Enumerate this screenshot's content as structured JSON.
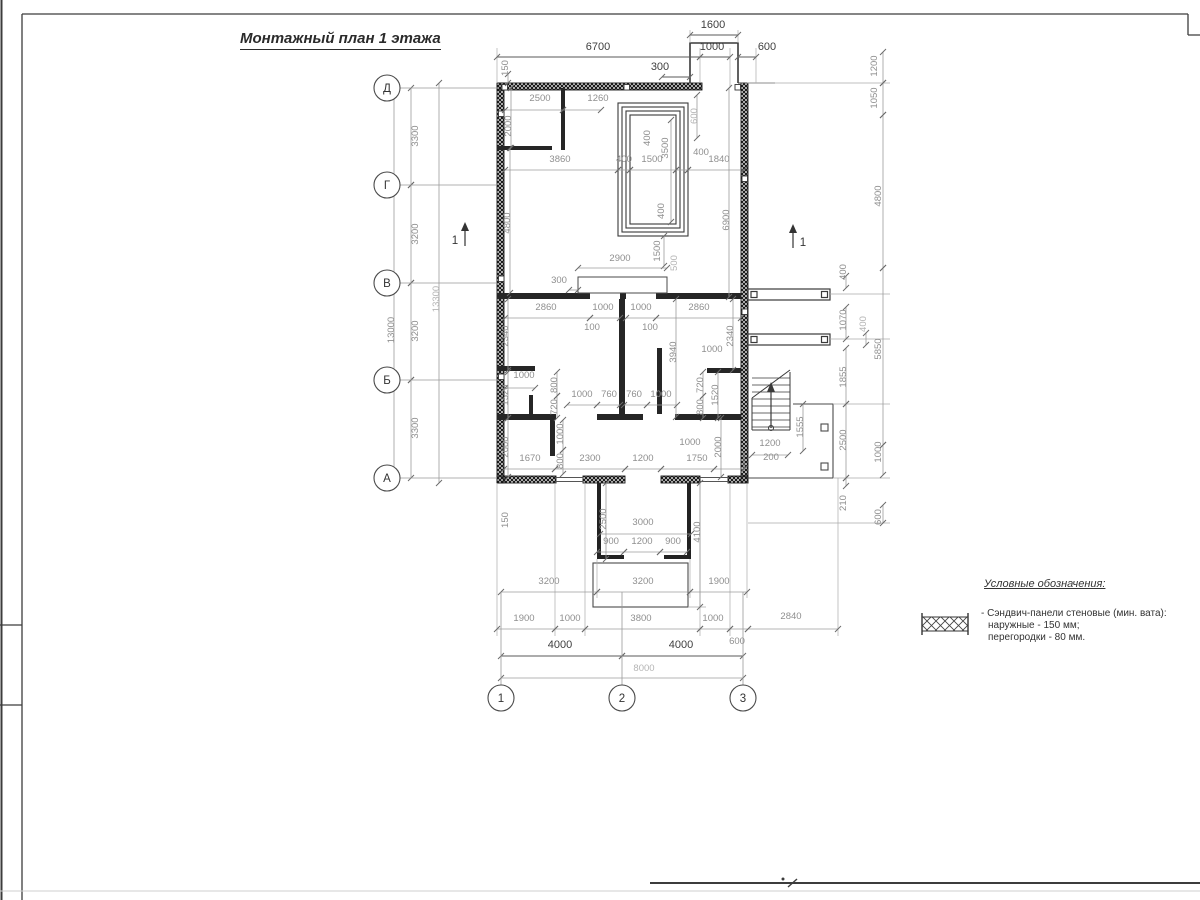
{
  "sheet": {
    "title": "Монтажный план 1 этажа"
  },
  "legend": {
    "title": "Условные обозначения:",
    "item": {
      "symbol": "sandwich-panel-hatch",
      "line1": "- Сэндвич-панели стеновые (мин. вата):",
      "line2": "наружные - 150 мм;",
      "line3": "перегородки - 80 мм."
    }
  },
  "plan": {
    "axes": {
      "rows": [
        {
          "label": "Д",
          "y": 88
        },
        {
          "label": "Г",
          "y": 185
        },
        {
          "label": "В",
          "y": 283
        },
        {
          "label": "Б",
          "y": 380
        },
        {
          "label": "А",
          "y": 478
        }
      ],
      "row_x": 387,
      "cols": [
        {
          "label": "1",
          "x": 501
        },
        {
          "label": "2",
          "x": 622
        },
        {
          "label": "3",
          "x": 743
        }
      ],
      "col_y": 698
    },
    "sections": [
      {
        "label": "1",
        "x": 465,
        "y1": 246,
        "y2": 222,
        "tx": 455,
        "ty": 244
      },
      {
        "label": "1",
        "x": 793,
        "y1": 248,
        "y2": 224,
        "tx": 803,
        "ty": 246
      }
    ],
    "dims": [
      {
        "t": "1600",
        "x": 713,
        "y": 28,
        "r": 0,
        "w": 2,
        "l": [
          690,
          35,
          738,
          35
        ]
      },
      {
        "t": "6700",
        "x": 598,
        "y": 50,
        "r": 0,
        "w": 2,
        "l": [
          497,
          57,
          700,
          57
        ]
      },
      {
        "t": "1000",
        "x": 712,
        "y": 50,
        "r": 0,
        "w": 2,
        "l": [
          700,
          57,
          730,
          57
        ]
      },
      {
        "t": "600",
        "x": 767,
        "y": 50,
        "r": 0,
        "w": 2,
        "l": [
          738,
          57,
          756,
          57
        ]
      },
      {
        "t": "300",
        "x": 660,
        "y": 70,
        "r": 0,
        "w": 2,
        "l": [
          662,
          77,
          690,
          77
        ]
      },
      {
        "t": "150",
        "x": 508,
        "y": 68,
        "r": 1,
        "w": 1,
        "l": [
          508,
          74,
          508,
          83
        ]
      },
      {
        "t": "2500",
        "x": 540,
        "y": 101,
        "r": 0,
        "w": 1,
        "l": [
          505,
          110,
          563,
          110
        ]
      },
      {
        "t": "1260",
        "x": 598,
        "y": 101,
        "r": 0,
        "w": 1,
        "l": [
          563,
          110,
          601,
          110
        ]
      },
      {
        "t": "2000",
        "x": 511,
        "y": 126,
        "r": 1,
        "w": 1,
        "l": [
          511,
          88,
          511,
          148
        ]
      },
      {
        "t": "600",
        "x": 697,
        "y": 116,
        "r": 1,
        "w": 0,
        "l": [
          697,
          95,
          697,
          138
        ]
      },
      {
        "t": "3860",
        "x": 560,
        "y": 162,
        "r": 0,
        "w": 1,
        "l": [
          505,
          170,
          618,
          170
        ]
      },
      {
        "t": "400",
        "x": 624,
        "y": 162,
        "r": 0,
        "w": 1,
        "l": [
          618,
          170,
          630,
          170
        ]
      },
      {
        "t": "1500",
        "x": 652,
        "y": 162,
        "r": 0,
        "w": 1,
        "l": [
          630,
          170,
          676,
          170
        ]
      },
      {
        "t": "400",
        "x": 701,
        "y": 155,
        "r": 0,
        "w": 1,
        "l": [
          676,
          170,
          688,
          170
        ]
      },
      {
        "t": "1840",
        "x": 719,
        "y": 162,
        "r": 0,
        "w": 1,
        "l": [
          688,
          170,
          744,
          170
        ]
      },
      {
        "t": "400",
        "x": 650,
        "y": 138,
        "r": 1,
        "w": 1
      },
      {
        "t": "3500",
        "x": 668,
        "y": 148,
        "r": 1,
        "w": 1,
        "l": [
          671,
          120,
          671,
          222
        ]
      },
      {
        "t": "400",
        "x": 664,
        "y": 211,
        "r": 1,
        "w": 1
      },
      {
        "t": "4800",
        "x": 510,
        "y": 223,
        "r": 1,
        "w": 1,
        "l": [
          510,
          148,
          510,
          293
        ]
      },
      {
        "t": "6900",
        "x": 729,
        "y": 220,
        "r": 1,
        "w": 1,
        "l": [
          729,
          88,
          729,
          297
        ]
      },
      {
        "t": "1500",
        "x": 660,
        "y": 251,
        "r": 1,
        "w": 1,
        "l": [
          664,
          236,
          664,
          266
        ]
      },
      {
        "t": "500",
        "x": 677,
        "y": 263,
        "r": 1,
        "w": 0
      },
      {
        "t": "2900",
        "x": 620,
        "y": 261,
        "r": 0,
        "w": 1,
        "l": [
          578,
          268,
          667,
          268
        ]
      },
      {
        "t": "300",
        "x": 559,
        "y": 283,
        "r": 0,
        "w": 1,
        "l": [
          569,
          290,
          578,
          290
        ]
      },
      {
        "t": "2860",
        "x": 546,
        "y": 310,
        "r": 0,
        "w": 1,
        "l": [
          505,
          318,
          590,
          318
        ]
      },
      {
        "t": "1000",
        "x": 603,
        "y": 310,
        "r": 0,
        "w": 1,
        "l": [
          590,
          318,
          620,
          318
        ]
      },
      {
        "t": "1000",
        "x": 641,
        "y": 310,
        "r": 0,
        "w": 1,
        "l": [
          626,
          318,
          656,
          318
        ]
      },
      {
        "t": "2860",
        "x": 699,
        "y": 310,
        "r": 0,
        "w": 1,
        "l": [
          656,
          318,
          741,
          318
        ]
      },
      {
        "t": "100",
        "x": 592,
        "y": 330,
        "r": 0,
        "w": 1
      },
      {
        "t": "100",
        "x": 650,
        "y": 330,
        "r": 0,
        "w": 1
      },
      {
        "t": "2340",
        "x": 508,
        "y": 336,
        "r": 1,
        "w": 1,
        "l": [
          508,
          299,
          508,
          370
        ]
      },
      {
        "t": "2340",
        "x": 733,
        "y": 336,
        "r": 1,
        "w": 1,
        "l": [
          733,
          299,
          733,
          370
        ]
      },
      {
        "t": "3940",
        "x": 676,
        "y": 352,
        "r": 1,
        "w": 1,
        "l": [
          676,
          299,
          676,
          417
        ]
      },
      {
        "t": "1000",
        "x": 712,
        "y": 352,
        "r": 0,
        "w": 1
      },
      {
        "t": "1000",
        "x": 524,
        "y": 378,
        "r": 0,
        "w": 1,
        "l": [
          505,
          388,
          535,
          388
        ]
      },
      {
        "t": "1520",
        "x": 508,
        "y": 395,
        "r": 1,
        "w": 1,
        "l": [
          508,
          372,
          508,
          418
        ]
      },
      {
        "t": "2000",
        "x": 508,
        "y": 447,
        "r": 1,
        "w": 1,
        "l": [
          508,
          418,
          508,
          477
        ]
      },
      {
        "t": "800",
        "x": 557,
        "y": 385,
        "r": 1,
        "w": 1,
        "l": [
          557,
          372,
          557,
          396
        ]
      },
      {
        "t": "720",
        "x": 557,
        "y": 407,
        "r": 1,
        "w": 1,
        "l": [
          557,
          396,
          557,
          418
        ]
      },
      {
        "t": "1000",
        "x": 582,
        "y": 397,
        "r": 0,
        "w": 1,
        "l": [
          567,
          405,
          597,
          405
        ]
      },
      {
        "t": "760",
        "x": 609,
        "y": 397,
        "r": 0,
        "w": 1,
        "l": [
          597,
          405,
          620,
          405
        ]
      },
      {
        "t": "760",
        "x": 634,
        "y": 397,
        "r": 0,
        "w": 1,
        "l": [
          624,
          405,
          647,
          405
        ]
      },
      {
        "t": "1000",
        "x": 661,
        "y": 397,
        "r": 0,
        "w": 1,
        "l": [
          647,
          405,
          677,
          405
        ]
      },
      {
        "t": "720",
        "x": 703,
        "y": 385,
        "r": 1,
        "w": 1,
        "l": [
          703,
          372,
          703,
          396
        ]
      },
      {
        "t": "800",
        "x": 703,
        "y": 407,
        "r": 1,
        "w": 1,
        "l": [
          703,
          396,
          703,
          418
        ]
      },
      {
        "t": "1520",
        "x": 718,
        "y": 395,
        "r": 1,
        "w": 1,
        "l": [
          718,
          372,
          718,
          418
        ]
      },
      {
        "t": "2000",
        "x": 721,
        "y": 447,
        "r": 1,
        "w": 1,
        "l": [
          721,
          418,
          721,
          477
        ]
      },
      {
        "t": "1000",
        "x": 563,
        "y": 434,
        "r": 1,
        "w": 1,
        "l": [
          563,
          420,
          563,
          450
        ]
      },
      {
        "t": "800",
        "x": 563,
        "y": 461,
        "r": 1,
        "w": 1,
        "l": [
          563,
          450,
          563,
          474
        ]
      },
      {
        "t": "1670",
        "x": 530,
        "y": 461,
        "r": 0,
        "w": 1,
        "l": [
          504,
          469,
          555,
          469
        ]
      },
      {
        "t": "2300",
        "x": 590,
        "y": 461,
        "r": 0,
        "w": 1,
        "l": [
          555,
          469,
          625,
          469
        ]
      },
      {
        "t": "1200",
        "x": 643,
        "y": 461,
        "r": 0,
        "w": 1,
        "l": [
          625,
          469,
          661,
          469
        ]
      },
      {
        "t": "1750",
        "x": 697,
        "y": 461,
        "r": 0,
        "w": 1,
        "l": [
          661,
          469,
          714,
          469
        ]
      },
      {
        "t": "1000",
        "x": 690,
        "y": 445,
        "r": 0,
        "w": 1,
        "l": [
          714,
          469,
          744,
          469
        ]
      },
      {
        "t": "150",
        "x": 508,
        "y": 520,
        "r": 1,
        "w": 1
      },
      {
        "t": "2500",
        "x": 606,
        "y": 519,
        "r": 1,
        "w": 1,
        "l": [
          606,
          483,
          606,
          559
        ]
      },
      {
        "t": "3000",
        "x": 643,
        "y": 525,
        "r": 0,
        "w": 1,
        "l": [
          600,
          534,
          691,
          534
        ]
      },
      {
        "t": "900",
        "x": 611,
        "y": 544,
        "r": 0,
        "w": 1,
        "l": [
          597,
          552,
          624,
          552
        ]
      },
      {
        "t": "1200",
        "x": 642,
        "y": 544,
        "r": 0,
        "w": 1,
        "l": [
          624,
          552,
          660,
          552
        ]
      },
      {
        "t": "900",
        "x": 673,
        "y": 544,
        "r": 0,
        "w": 1,
        "l": [
          660,
          552,
          687,
          552
        ]
      },
      {
        "t": "4100",
        "x": 700,
        "y": 532,
        "r": 1,
        "w": 1,
        "l": [
          700,
          483,
          700,
          607
        ]
      },
      {
        "t": "3200",
        "x": 549,
        "y": 584,
        "r": 0,
        "w": 1,
        "l": [
          501,
          592,
          597,
          592
        ]
      },
      {
        "t": "3200",
        "x": 643,
        "y": 584,
        "r": 0,
        "w": 1,
        "l": [
          597,
          592,
          690,
          592
        ]
      },
      {
        "t": "1900",
        "x": 719,
        "y": 584,
        "r": 0,
        "w": 1,
        "l": [
          690,
          592,
          747,
          592
        ]
      },
      {
        "t": "1900",
        "x": 524,
        "y": 621,
        "r": 0,
        "w": 1,
        "l": [
          497,
          629,
          555,
          629
        ]
      },
      {
        "t": "1000",
        "x": 570,
        "y": 621,
        "r": 0,
        "w": 1,
        "l": [
          555,
          629,
          585,
          629
        ]
      },
      {
        "t": "3800",
        "x": 641,
        "y": 621,
        "r": 0,
        "w": 1,
        "l": [
          585,
          629,
          700,
          629
        ]
      },
      {
        "t": "1000",
        "x": 713,
        "y": 621,
        "r": 0,
        "w": 1,
        "l": [
          700,
          629,
          730,
          629
        ]
      },
      {
        "t": "2840",
        "x": 791,
        "y": 619,
        "r": 0,
        "w": 1,
        "l": [
          748,
          629,
          838,
          629
        ]
      },
      {
        "t": "600",
        "x": 737,
        "y": 644,
        "r": 0,
        "w": 1,
        "l": [
          730,
          629,
          748,
          629
        ]
      },
      {
        "t": "4000",
        "x": 560,
        "y": 648,
        "r": 0,
        "w": 2,
        "l": [
          501,
          656,
          622,
          656
        ]
      },
      {
        "t": "4000",
        "x": 681,
        "y": 648,
        "r": 0,
        "w": 2,
        "l": [
          622,
          656,
          743,
          656
        ]
      },
      {
        "t": "8000",
        "x": 644,
        "y": 671,
        "r": 0,
        "w": 0,
        "l": [
          501,
          678,
          743,
          678
        ]
      },
      {
        "t": "3300",
        "x": 418,
        "y": 136,
        "r": 1,
        "w": 1,
        "l": [
          411,
          88,
          411,
          185
        ]
      },
      {
        "t": "3200",
        "x": 418,
        "y": 234,
        "r": 1,
        "w": 1,
        "l": [
          411,
          185,
          411,
          283
        ]
      },
      {
        "t": "3200",
        "x": 418,
        "y": 331,
        "r": 1,
        "w": 1,
        "l": [
          411,
          283,
          411,
          380
        ]
      },
      {
        "t": "3300",
        "x": 418,
        "y": 428,
        "r": 1,
        "w": 1,
        "l": [
          411,
          380,
          411,
          478
        ]
      },
      {
        "t": "13000",
        "x": 394,
        "y": 330,
        "r": 1,
        "w": 1,
        "l": [
          394,
          88,
          394,
          478
        ]
      },
      {
        "t": "13300",
        "x": 439,
        "y": 299,
        "r": 1,
        "w": 0,
        "l": [
          439,
          83,
          439,
          483
        ]
      },
      {
        "t": "1200",
        "x": 877,
        "y": 66,
        "r": 1,
        "w": 1,
        "l": [
          883,
          52,
          883,
          83
        ]
      },
      {
        "t": "1050",
        "x": 877,
        "y": 98,
        "r": 1,
        "w": 1,
        "l": [
          883,
          83,
          883,
          115
        ]
      },
      {
        "t": "4800",
        "x": 881,
        "y": 196,
        "r": 1,
        "w": 1,
        "l": [
          883,
          115,
          883,
          268
        ]
      },
      {
        "t": "5850",
        "x": 881,
        "y": 349,
        "r": 1,
        "w": 1,
        "l": [
          883,
          268,
          883,
          445
        ]
      },
      {
        "t": "1000",
        "x": 881,
        "y": 452,
        "r": 1,
        "w": 1,
        "l": [
          883,
          445,
          883,
          475
        ]
      },
      {
        "t": "600",
        "x": 881,
        "y": 517,
        "r": 1,
        "w": 1,
        "l": [
          883,
          505,
          883,
          523
        ]
      },
      {
        "t": "400",
        "x": 846,
        "y": 272,
        "r": 1,
        "w": 1,
        "l": [
          846,
          276,
          846,
          288
        ]
      },
      {
        "t": "1070",
        "x": 846,
        "y": 320,
        "r": 1,
        "w": 1,
        "l": [
          846,
          307,
          846,
          339
        ]
      },
      {
        "t": "400",
        "x": 866,
        "y": 324,
        "r": 1,
        "w": 0,
        "l": [
          866,
          333,
          866,
          345
        ]
      },
      {
        "t": "1855",
        "x": 846,
        "y": 377,
        "r": 1,
        "w": 1,
        "l": [
          846,
          348,
          846,
          404
        ]
      },
      {
        "t": "2500",
        "x": 846,
        "y": 440,
        "r": 1,
        "w": 1,
        "l": [
          846,
          404,
          846,
          478
        ]
      },
      {
        "t": "210",
        "x": 846,
        "y": 503,
        "r": 1,
        "w": 1,
        "l": [
          846,
          478,
          846,
          486
        ]
      },
      {
        "t": "1200",
        "x": 770,
        "y": 446,
        "r": 0,
        "w": 1,
        "l": [
          752,
          455,
          788,
          455
        ]
      },
      {
        "t": "200",
        "x": 771,
        "y": 460,
        "r": 0,
        "w": 1
      },
      {
        "t": "1555",
        "x": 803,
        "y": 427,
        "r": 1,
        "w": 1,
        "l": [
          803,
          404,
          803,
          451
        ]
      }
    ]
  }
}
